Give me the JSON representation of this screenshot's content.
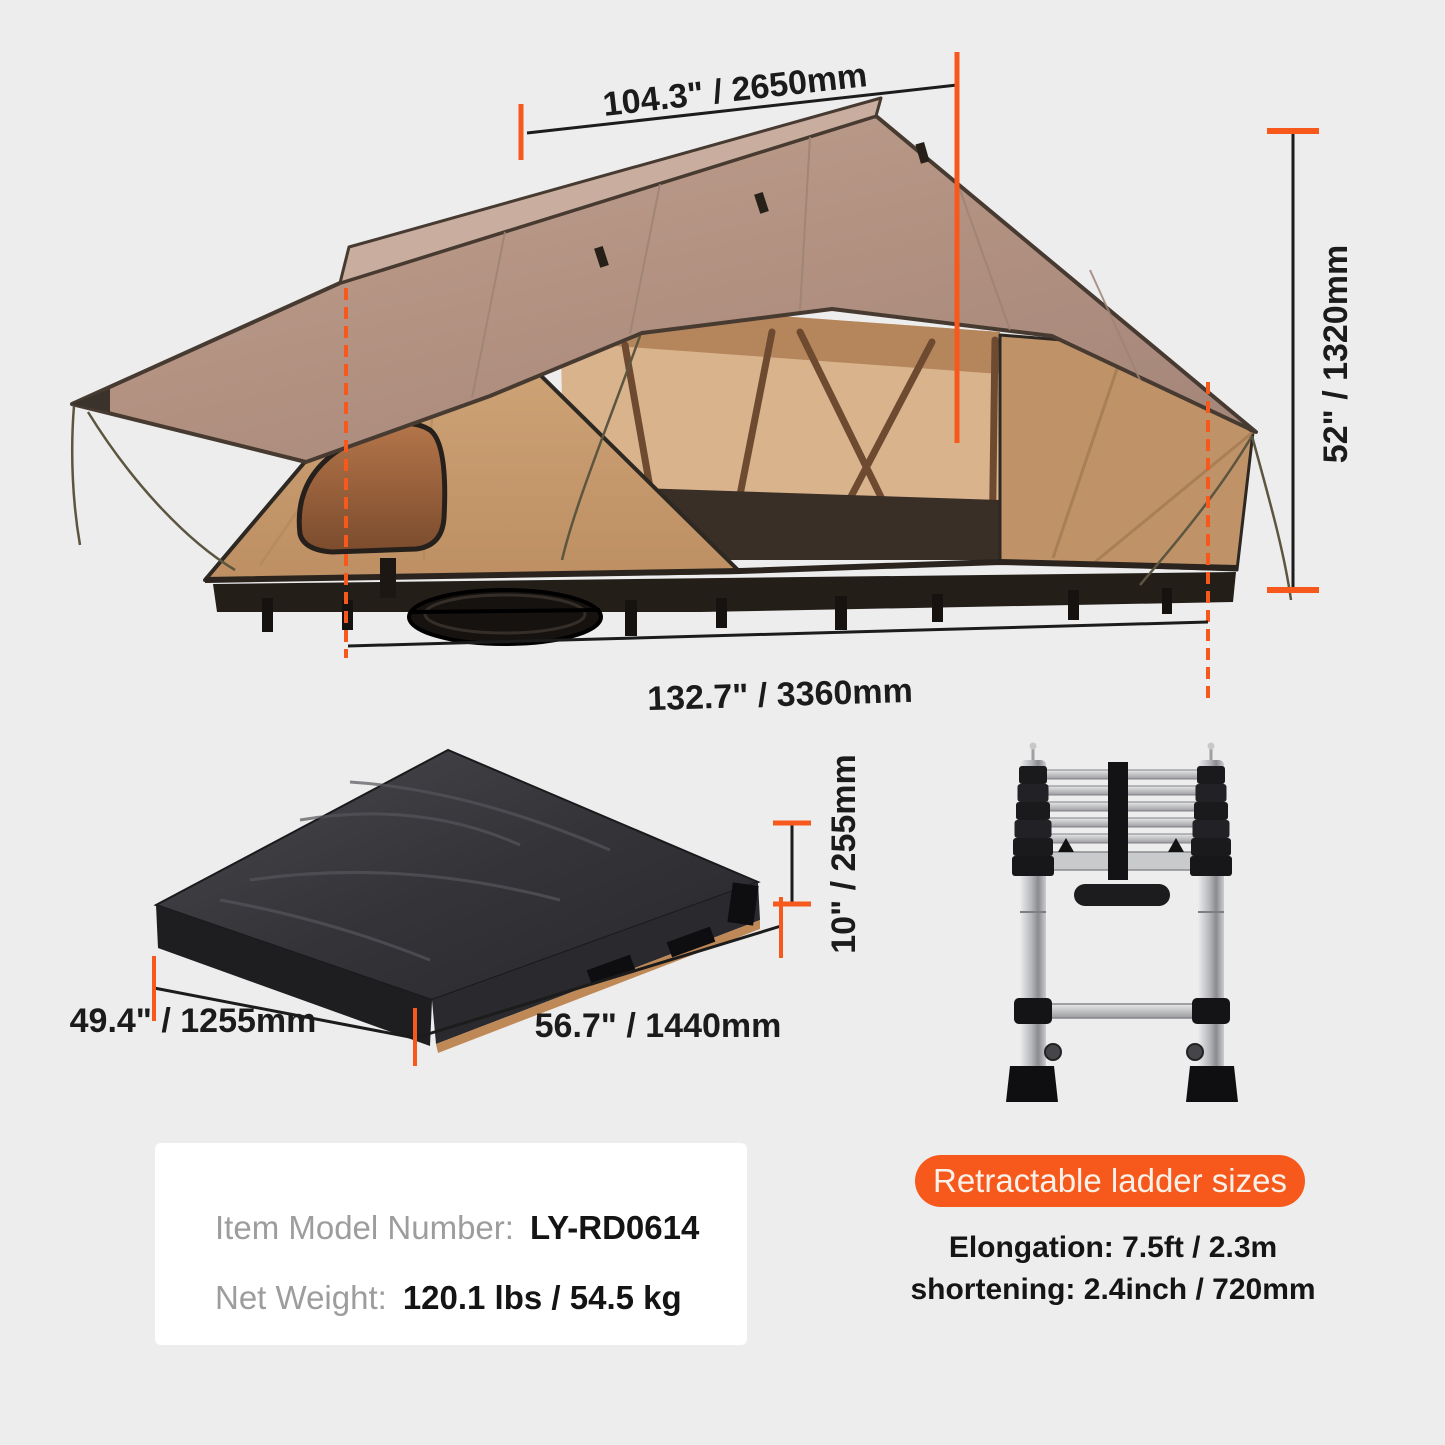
{
  "page": {
    "background": "#ededee",
    "description_of_figures": {
      "tent": "soft-shell rooftop tent shown opened",
      "package": "tent folded inside black transport cover",
      "ladder": "telescopic ladder shown retracted"
    }
  },
  "dimensions": {
    "tent_width": "104.3\" / 2650mm",
    "tent_height": "52\" / 1320mm",
    "tent_length": "132.7\" / 3360mm",
    "package_depth": "49.4\" / 1255mm",
    "package_length": "56.7\" / 1440mm",
    "package_height": "10\" / 255mm"
  },
  "product_info": {
    "model_label": "Item Model Number:",
    "model_value": "LY-RD0614",
    "weight_label": "Net Weight:",
    "weight_value": "120.1 lbs / 54.5 kg"
  },
  "ladder": {
    "badge": "Retractable ladder sizes",
    "elongation": "Elongation: 7.5ft / 2.3m",
    "shortening": "shortening: 2.4inch / 720mm"
  },
  "colors": {
    "accent_orange": "#f7591c",
    "dimension_line": "#1c1c1c",
    "background": "#ededee",
    "card_background": "#ffffff",
    "label_gray": "#9d9d9d",
    "text_dark": "#141414",
    "tent_fly": "#b29181",
    "tent_fly_top": "#c9aea0",
    "tent_wall": "#c79a6e",
    "tent_window": "#a4693e",
    "package_cover": "#323236",
    "package_edge_tan": "#bf8957",
    "ladder_silver": "#b5b6b9"
  }
}
